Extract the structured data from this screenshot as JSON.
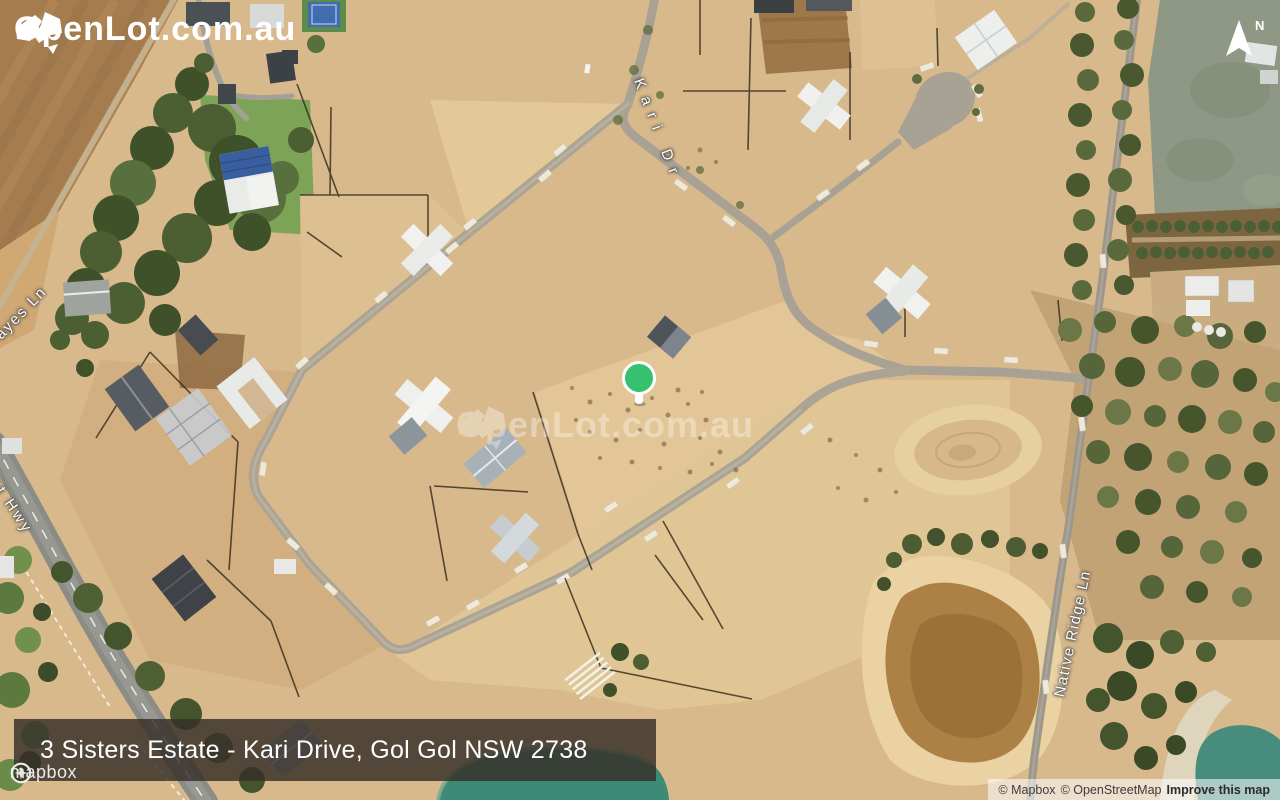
{
  "brand": {
    "logo_text": "OpenLot.com.au"
  },
  "map": {
    "watermark_text": "OpenLot.com.au",
    "north_label": "N",
    "marker_color": "#35c16d",
    "street_labels": [
      {
        "name": "Kari Dr"
      },
      {
        "name": "ayes Ln"
      },
      {
        "name": "urt Hwy"
      },
      {
        "name": "Native Ridge Ln"
      }
    ],
    "banner_title": "3 Sisters Estate - Kari Drive, Gol Gol NSW 2738"
  },
  "footer": {
    "mapbox_wordmark": "mapbox",
    "attribution": {
      "mapbox": "© Mapbox",
      "openstreetmap": "© OpenStreetMap",
      "improve": "Improve this map"
    }
  }
}
